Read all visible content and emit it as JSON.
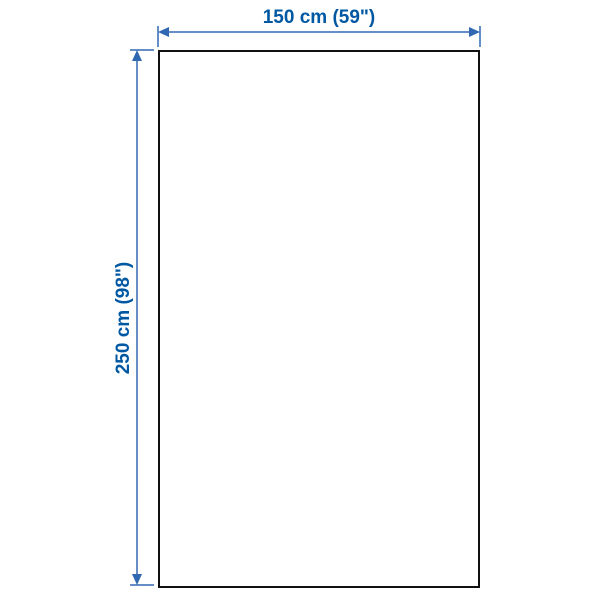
{
  "diagram": {
    "type": "product-dimension-diagram",
    "width_label": "150 cm (59\")",
    "height_label": "250 cm (98\")",
    "colors": {
      "dimension_text": "#0058A3",
      "dimension_line": "#3069B2",
      "outline": "#111111",
      "background": "#FFFFFF"
    }
  }
}
